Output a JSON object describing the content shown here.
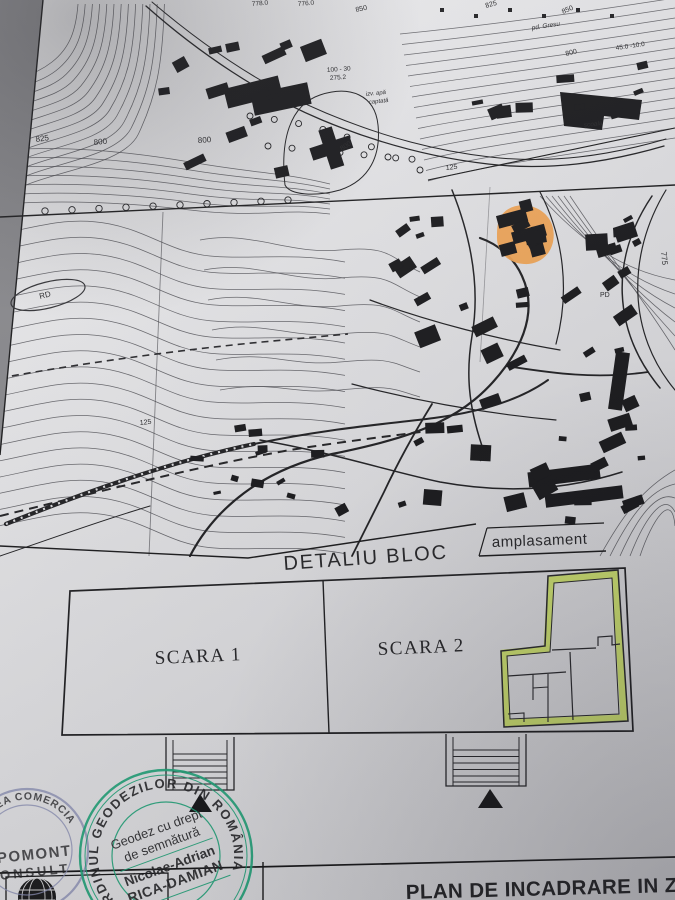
{
  "document_kind": "site plan photo",
  "colors": {
    "ink": "#18181b",
    "paper_light": "#ececee",
    "paper_dark": "#d6d6d9",
    "highlight_orange": "#f0a14f",
    "highlight_green": "#c9e254",
    "stamp_green": "#1ba377",
    "stamp_purple": "#8a8fb5"
  },
  "map": {
    "labels": [
      {
        "t": "825",
        "x": 36,
        "y": 142,
        "r": -8,
        "s": 8
      },
      {
        "t": "800",
        "x": 94,
        "y": 145,
        "r": -6,
        "s": 8
      },
      {
        "t": "800",
        "x": 198,
        "y": 143,
        "r": -4,
        "s": 8
      },
      {
        "t": "778.0",
        "x": 252,
        "y": 6,
        "r": -5,
        "s": 6.5
      },
      {
        "t": "776.0",
        "x": 298,
        "y": 6,
        "r": -5,
        "s": 6.5
      },
      {
        "t": "850",
        "x": 356,
        "y": 12,
        "r": -12,
        "s": 7
      },
      {
        "t": "825",
        "x": 486,
        "y": 8,
        "r": -16,
        "s": 7
      },
      {
        "t": "850",
        "x": 563,
        "y": 14,
        "r": -24,
        "s": 7
      },
      {
        "t": "pd. Gresu",
        "x": 532,
        "y": 30,
        "r": -9,
        "s": 6.5,
        "i": 1
      },
      {
        "t": "800",
        "x": 566,
        "y": 56,
        "r": -14,
        "s": 7
      },
      {
        "t": "45.0 -10.0",
        "x": 616,
        "y": 50,
        "r": -8,
        "s": 6.5
      },
      {
        "t": "şcoala",
        "x": 584,
        "y": 127,
        "r": -6,
        "s": 6.5,
        "i": 1
      },
      {
        "t": "100 - 30",
        "x": 327,
        "y": 72,
        "r": -4,
        "s": 6.5
      },
      {
        "t": "275.2",
        "x": 330,
        "y": 80,
        "r": -4,
        "s": 6.5
      },
      {
        "t": "izv. apă",
        "x": 366,
        "y": 96,
        "r": -6,
        "s": 6,
        "i": 1
      },
      {
        "t": "captată",
        "x": 369,
        "y": 104,
        "r": -6,
        "s": 6,
        "i": 1
      },
      {
        "t": "800",
        "x": 342,
        "y": 151,
        "r": -34,
        "s": 7
      },
      {
        "t": "125",
        "x": 446,
        "y": 170,
        "r": -6,
        "s": 7
      },
      {
        "t": "125",
        "x": 140,
        "y": 425,
        "r": -6,
        "s": 7
      },
      {
        "t": "775",
        "x": 661,
        "y": 252,
        "r": 84,
        "s": 8
      },
      {
        "t": "RD",
        "x": 40,
        "y": 299,
        "r": -14,
        "s": 8
      },
      {
        "t": "PD",
        "x": 600,
        "y": 297,
        "r": 0,
        "s": 7
      }
    ]
  },
  "detail": {
    "title": "DETALIU BLOC",
    "callout_label": "amplasament",
    "entrance1_label": "SCARA 1",
    "entrance2_label": "SCARA 2"
  },
  "title_block": {
    "plan_title": "PLAN DE INCADRARE IN ZO"
  },
  "stamps": {
    "company": {
      "arc_text": "ATEA COMERCIA",
      "line1": "OPOMONT",
      "line2": "CONSULT"
    },
    "surveyor": {
      "arc_text": "ORDINUL GEODEZILOR DIN ROMÂNIA",
      "line1": "Geodez cu drept",
      "line2": "de semnătură",
      "name1": "Nicolae-Adrian",
      "name2": "RICA-DAMIAN"
    }
  }
}
